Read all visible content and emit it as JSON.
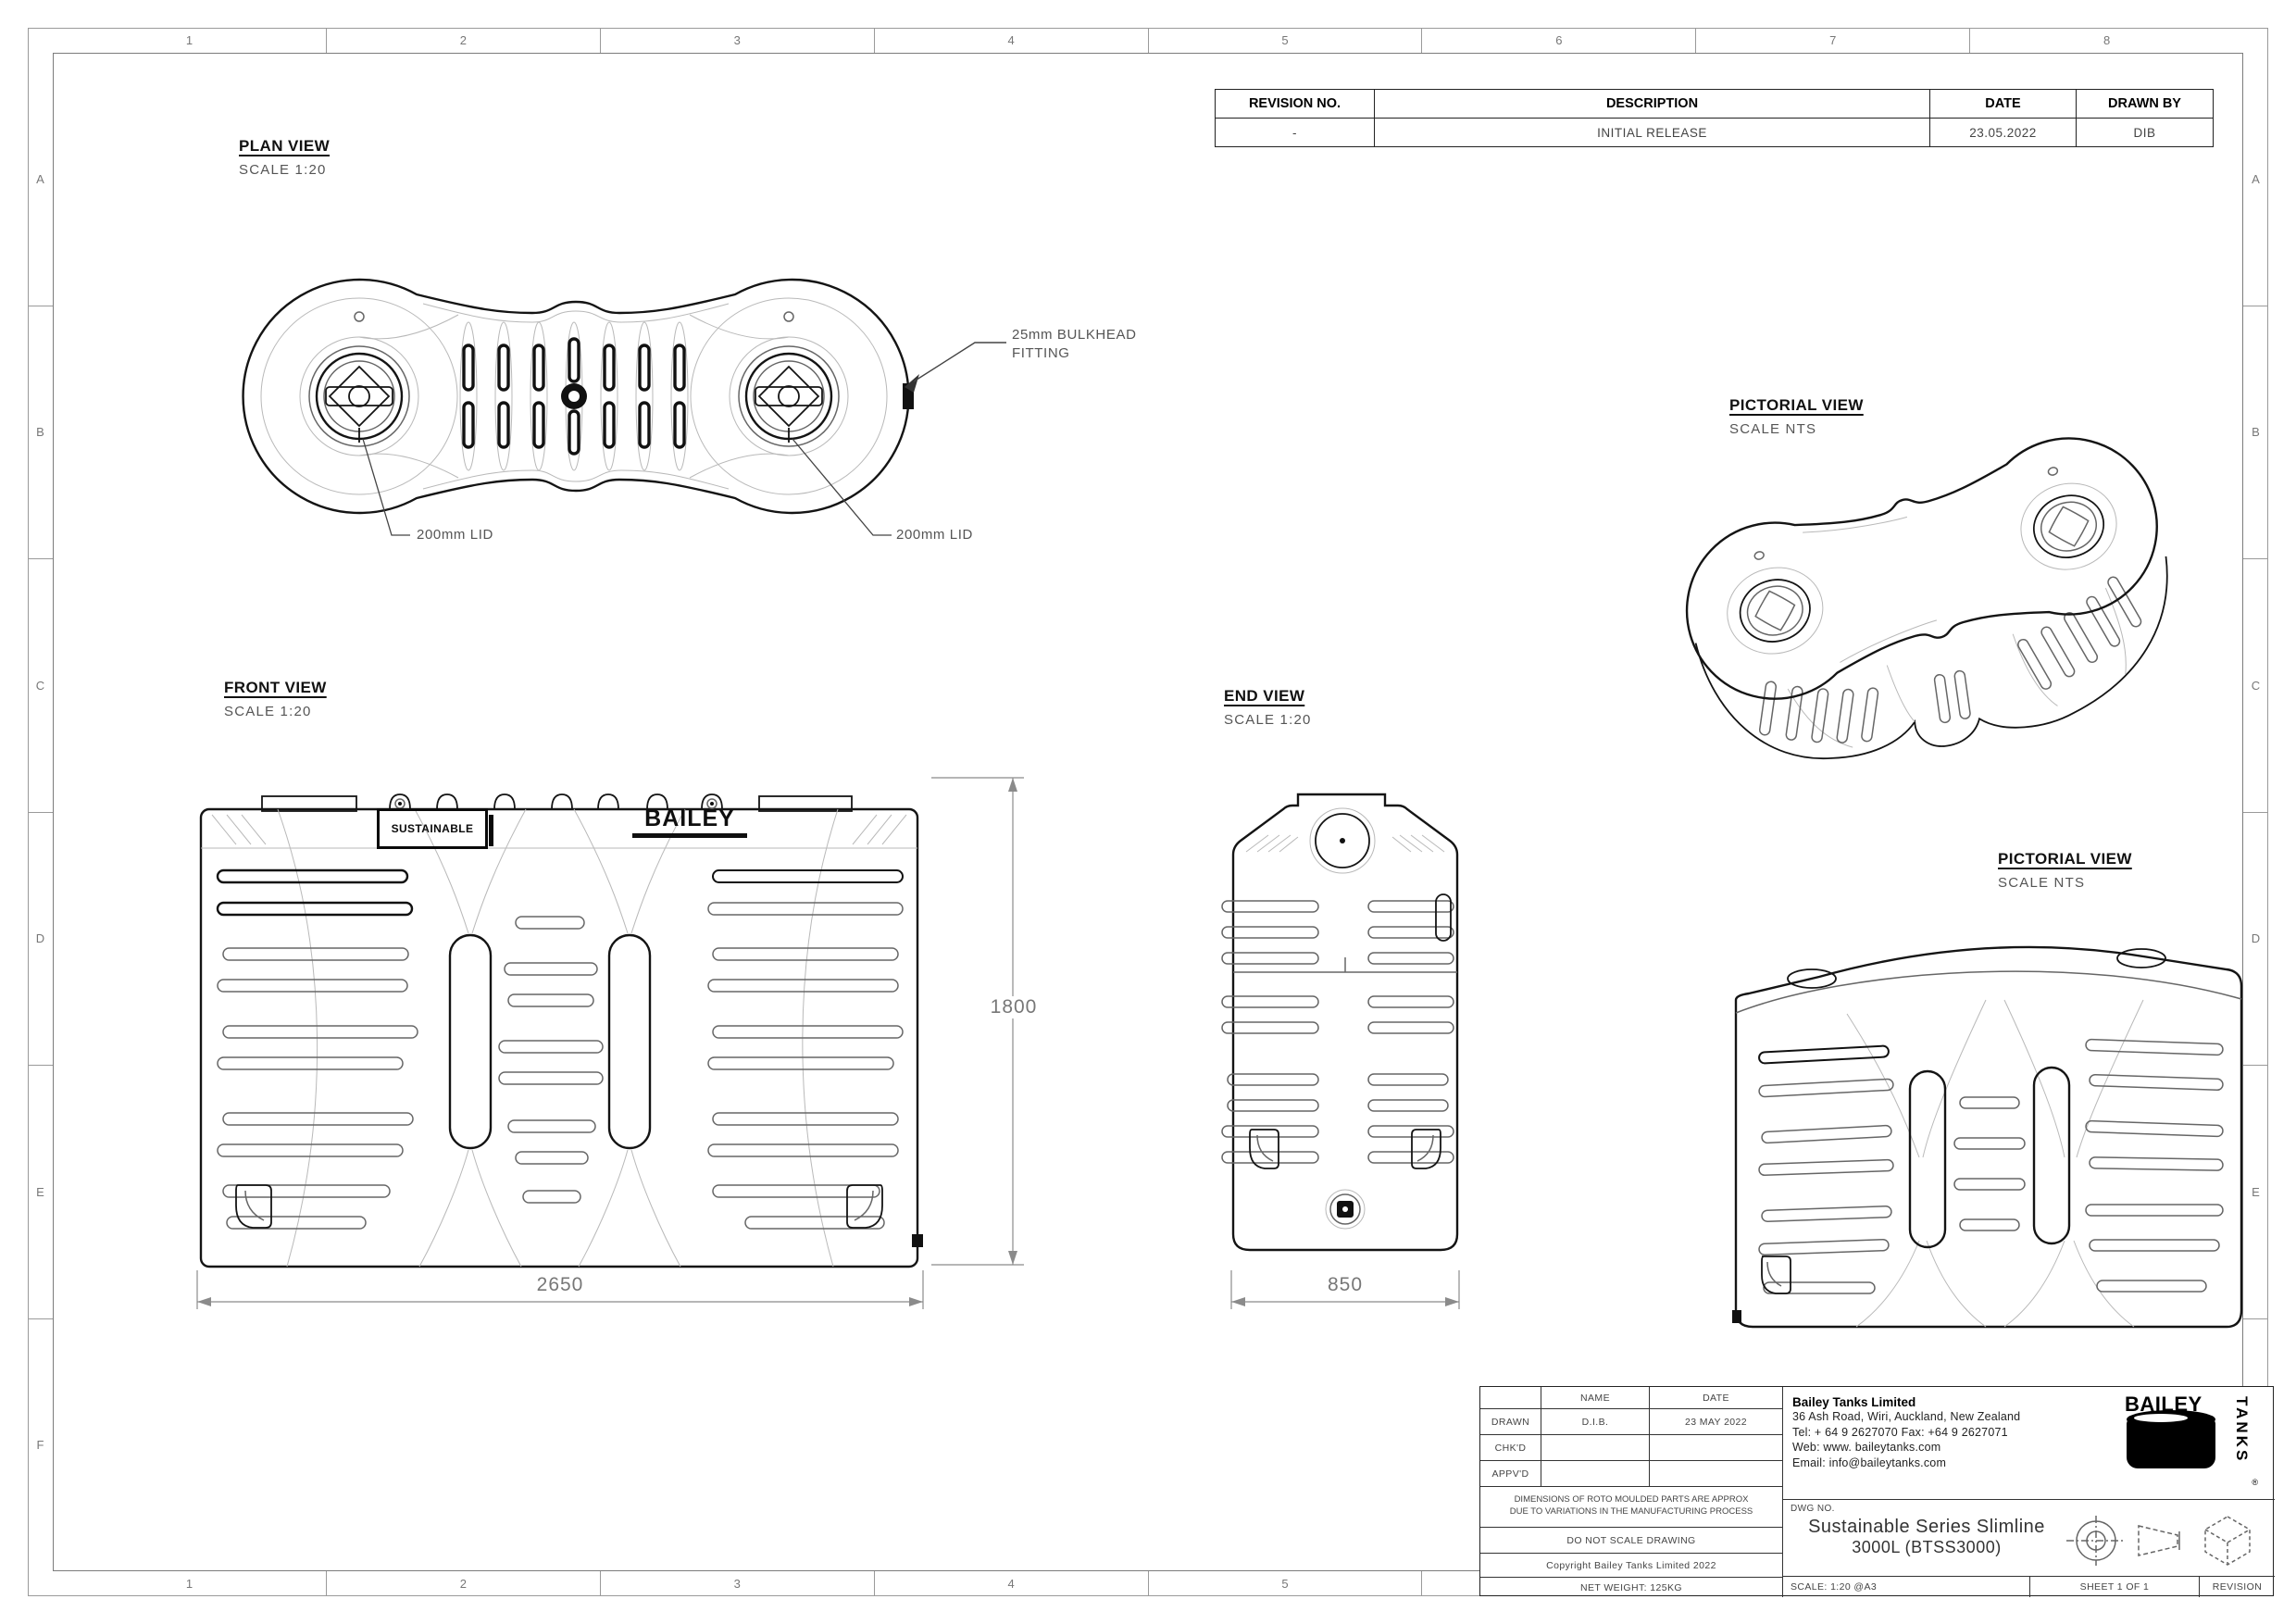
{
  "sheet": {
    "grid_columns": [
      "1",
      "2",
      "3",
      "4",
      "5",
      "6",
      "7",
      "8"
    ],
    "grid_rows": [
      "A",
      "B",
      "C",
      "D",
      "E",
      "F"
    ]
  },
  "revision_table": {
    "headers": [
      "REVISION NO.",
      "DESCRIPTION",
      "DATE",
      "DRAWN BY"
    ],
    "rows": [
      [
        "-",
        "INITIAL RELEASE",
        "23.05.2022",
        "DIB"
      ]
    ]
  },
  "views": {
    "plan": {
      "title": "PLAN VIEW",
      "scale": "SCALE 1:20"
    },
    "front": {
      "title": "FRONT VIEW",
      "scale": "SCALE 1:20"
    },
    "end": {
      "title": "END VIEW",
      "scale": "SCALE 1:20"
    },
    "pictorial_top": {
      "title": "PICTORIAL VIEW",
      "scale": "SCALE NTS"
    },
    "pictorial_bottom": {
      "title": "PICTORIAL VIEW",
      "scale": "SCALE NTS"
    }
  },
  "callouts": {
    "bulkhead_fitting": "25mm BULKHEAD FITTING",
    "lid_left": "200mm LID",
    "lid_right": "200mm LID"
  },
  "dimensions": {
    "front_width": "2650",
    "front_height": "1800",
    "end_width": "850"
  },
  "branding": {
    "sustainable": "SUSTAINABLE",
    "bailey": "BAILEY"
  },
  "title_block": {
    "approval": {
      "name_header": "NAME",
      "date_header": "DATE",
      "rows": [
        {
          "label": "DRAWN",
          "name": "D.I.B.",
          "date": "23 MAY 2022"
        },
        {
          "label": "CHK'D",
          "name": "",
          "date": ""
        },
        {
          "label": "APPV'D",
          "name": "",
          "date": ""
        }
      ]
    },
    "note_line1": "DIMENSIONS OF ROTO MOULDED PARTS ARE APPROX",
    "note_line2": "DUE TO VARIATIONS IN THE MANUFACTURING PROCESS",
    "do_not_scale": "DO NOT SCALE DRAWING",
    "copyright": "Copyright Bailey Tanks Limited 2022",
    "net_weight": "NET WEIGHT: 125KG",
    "company": {
      "name": "Bailey Tanks Limited",
      "address": "36 Ash Road, Wiri, Auckland, New Zealand",
      "phone": "Tel: + 64 9 2627070 Fax: +64 9 2627071",
      "web": "Web: www. baileytanks.com",
      "email": "Email: info@baileytanks.com"
    },
    "dwg_no_label": "DWG NO.",
    "drawing_title_line1": "Sustainable Series Slimline",
    "drawing_title_line2": "3000L (BTSS3000)",
    "scale_label": "SCALE:  1:20 @A3",
    "sheet_label": "SHEET 1 OF 1",
    "revision_label": "REVISION",
    "paper_size": "A3",
    "logo": {
      "word1": "BAILEY",
      "word2": "TANKS",
      "reg": "®"
    }
  }
}
